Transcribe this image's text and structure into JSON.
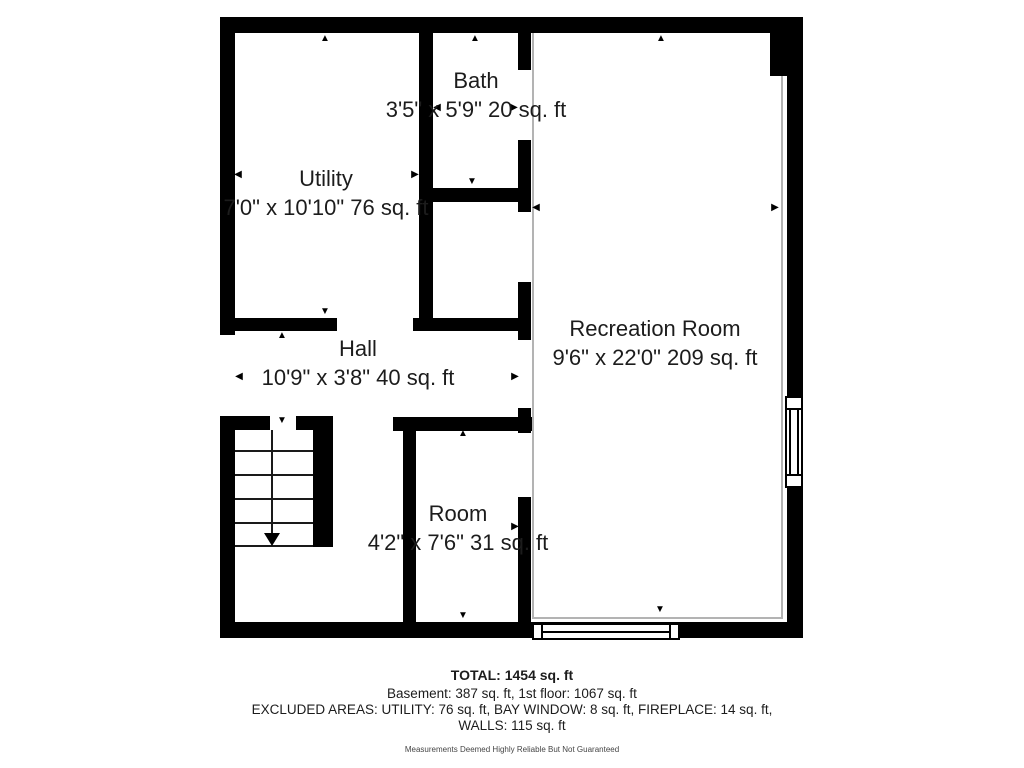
{
  "plan": {
    "rooms": [
      {
        "label": "Utility",
        "dims": "7'0\" x 10'10\" 76 sq. ft"
      },
      {
        "label": "Bath",
        "dims": "3'5\" x 5'9\" 20 sq. ft"
      },
      {
        "label": "Hall",
        "dims": "10'9\" x 3'8\" 40 sq. ft"
      },
      {
        "label": "Recreation Room",
        "dims": "9'6\" x 22'0\" 209 sq. ft"
      },
      {
        "label": "Room",
        "dims": "4'2\" x 7'6\" 31 sq. ft"
      }
    ],
    "summary": {
      "total": "TOTAL: 1454 sq. ft",
      "floors": "Basement: 387 sq. ft, 1st floor: 1067 sq. ft",
      "excluded_line1": "EXCLUDED AREAS: UTILITY: 76 sq. ft, BAY WINDOW: 8 sq. ft, FIREPLACE: 14 sq. ft,",
      "excluded_line2": "WALLS: 115 sq. ft",
      "disclaimer": "Measurements Deemed Highly Reliable But Not Guaranteed"
    },
    "icons": {
      "up": "▲",
      "down": "▼",
      "left": "◀",
      "right": "▶"
    },
    "colors": {
      "wall": "#000000",
      "text": "#1c1c1c",
      "floor_outline": "#b3b3b3",
      "background": "#ffffff"
    }
  }
}
